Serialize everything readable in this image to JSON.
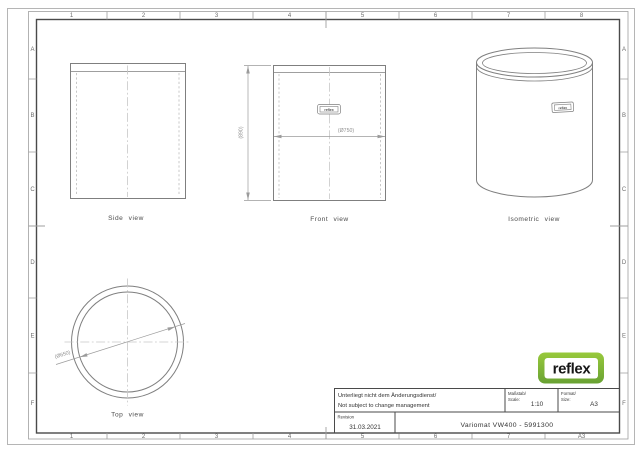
{
  "colors": {
    "paper": "#ffffff",
    "outer-line": "#b5b5b5",
    "band-line": "#9f9f9f",
    "frame-line": "#4a4a4a",
    "line": "#7f7f7f",
    "hidden-line": "#c3c3c3",
    "center-line": "#c7c7c7",
    "dim-line": "#9b9b9b",
    "dim-text": "#909090",
    "grid-text": "#6e6e6e",
    "label-text": "#4c4c4c",
    "tb-text": "#333333",
    "logo-green-top": "#98c93c",
    "logo-green-bottom": "#69a233",
    "logo-text": "#161616"
  },
  "grid": {
    "top": [
      "1",
      "2",
      "3",
      "4",
      "5",
      "6",
      "7",
      "8"
    ],
    "bottom": [
      "1",
      "2",
      "3",
      "4",
      "5",
      "6",
      "7",
      "A3"
    ],
    "left": [
      "A",
      "B",
      "C",
      "D",
      "E",
      "F"
    ],
    "right": [
      "A",
      "B",
      "C",
      "D",
      "E",
      "F"
    ]
  },
  "views": {
    "side": {
      "label": "Side view"
    },
    "front": {
      "label": "Front view",
      "height_dim": "(890)",
      "diameter_dim": "(Ø750)",
      "nameplate": "reflex"
    },
    "isometric": {
      "label": "Isometric view",
      "nameplate": "reflex"
    },
    "top": {
      "label": "Top view",
      "diameter_dim": "(Ø650)"
    }
  },
  "title_block": {
    "note_de": "Unterliegt nicht dem Änderungsdienst/",
    "note_en": "Not subject to change management",
    "scale_label_de": "Maßstab/",
    "scale_label_en": "Scale:",
    "scale_value": "1:10",
    "format_label_de": "Format/",
    "format_label_en": "Size:",
    "format_value": "A3",
    "revision_label": "Revision",
    "revision_value": "31.03.2021",
    "title": "Variomat VW400 - 5991300"
  },
  "logo": {
    "text": "reflex"
  }
}
